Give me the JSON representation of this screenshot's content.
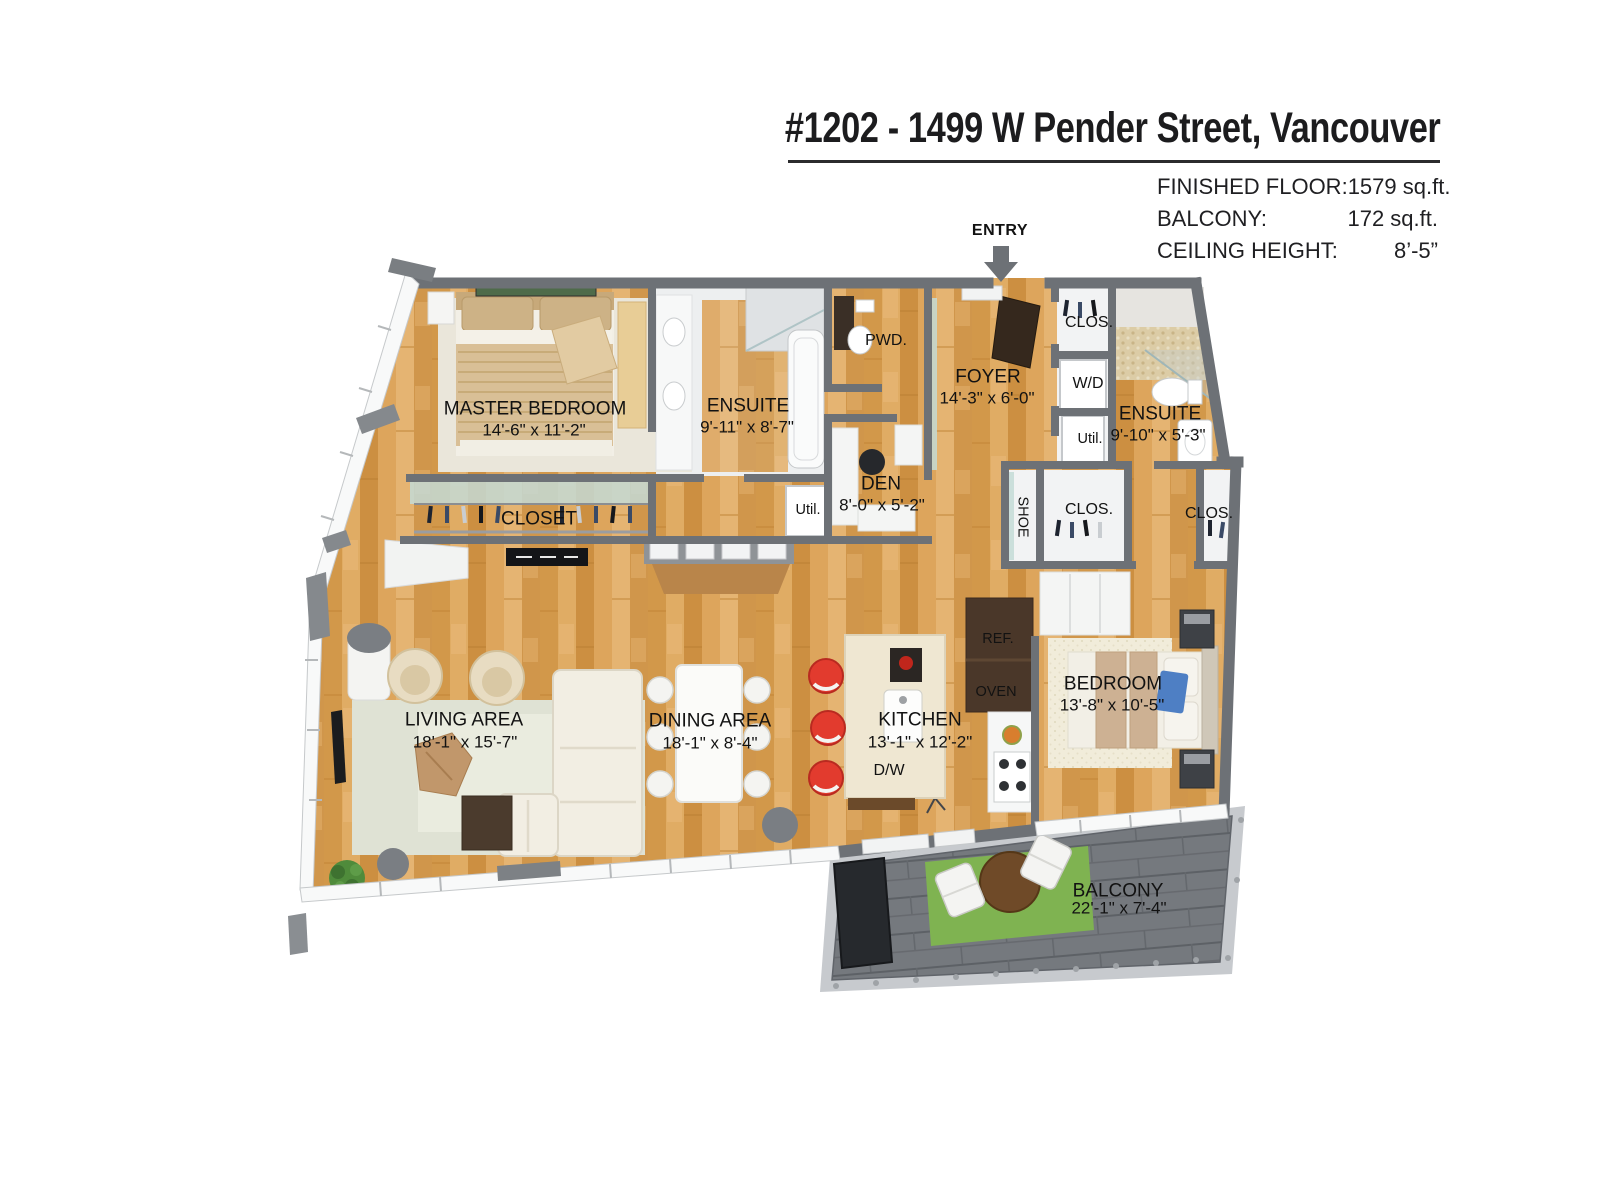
{
  "header": {
    "title": "#1202 - 1499 W Pender Street, Vancouver",
    "stats": [
      {
        "label": "FINISHED FLOOR:",
        "value": "1579 sq.ft."
      },
      {
        "label": "BALCONY:",
        "value": "172 sq.ft."
      },
      {
        "label": "CEILING HEIGHT:",
        "value": "8’-5”"
      }
    ]
  },
  "entry": {
    "label": "ENTRY"
  },
  "rooms": {
    "master_bedroom": {
      "name": "MASTER BEDROOM",
      "dims": "14'-6\" x 11'-2\""
    },
    "ensuite_master": {
      "name": "ENSUITE",
      "dims": "9'-11\" x 8'-7\""
    },
    "powder": {
      "name": "PWD."
    },
    "foyer": {
      "name": "FOYER",
      "dims": "14'-3\" x 6'-0\""
    },
    "closet_hall": {
      "name": "CLOS."
    },
    "washer_dryer": {
      "name": "W/D"
    },
    "util_right": {
      "name": "Util."
    },
    "ensuite_second": {
      "name": "ENSUITE",
      "dims": "9'-10\" x 5'-3\""
    },
    "den": {
      "name": "DEN",
      "dims": "8'-0\" x 5'-2\""
    },
    "util_left": {
      "name": "Util."
    },
    "closet_master": {
      "name": "CLOSET"
    },
    "shoe_closet": {
      "name": "SHOE"
    },
    "closet_mid": {
      "name": "CLOS."
    },
    "closet_right": {
      "name": "CLOS."
    },
    "living": {
      "name": "LIVING AREA",
      "dims": "18'-1\" x 15'-7\""
    },
    "dining": {
      "name": "DINING AREA",
      "dims": "18'-1\" x 8'-4\""
    },
    "kitchen": {
      "name": "KITCHEN",
      "dims": "13'-1\" x 12'-2\""
    },
    "dishwasher": {
      "name": "D/W"
    },
    "fridge": {
      "name": "REF."
    },
    "oven": {
      "name": "OVEN"
    },
    "bedroom": {
      "name": "BEDROOM",
      "dims": "13'-8\" x 10'-5\""
    },
    "balcony": {
      "name": "BALCONY",
      "dims": "22'-1\" x 7'-4\""
    }
  },
  "colors": {
    "wood_floor": "#D9A258",
    "walls": "#6D7176",
    "balcony_deck": "#75797E",
    "stool_red": "#E23B2E",
    "balcony_rug_green": "#7FB351",
    "pillow_blue": "#4E7FC4"
  }
}
